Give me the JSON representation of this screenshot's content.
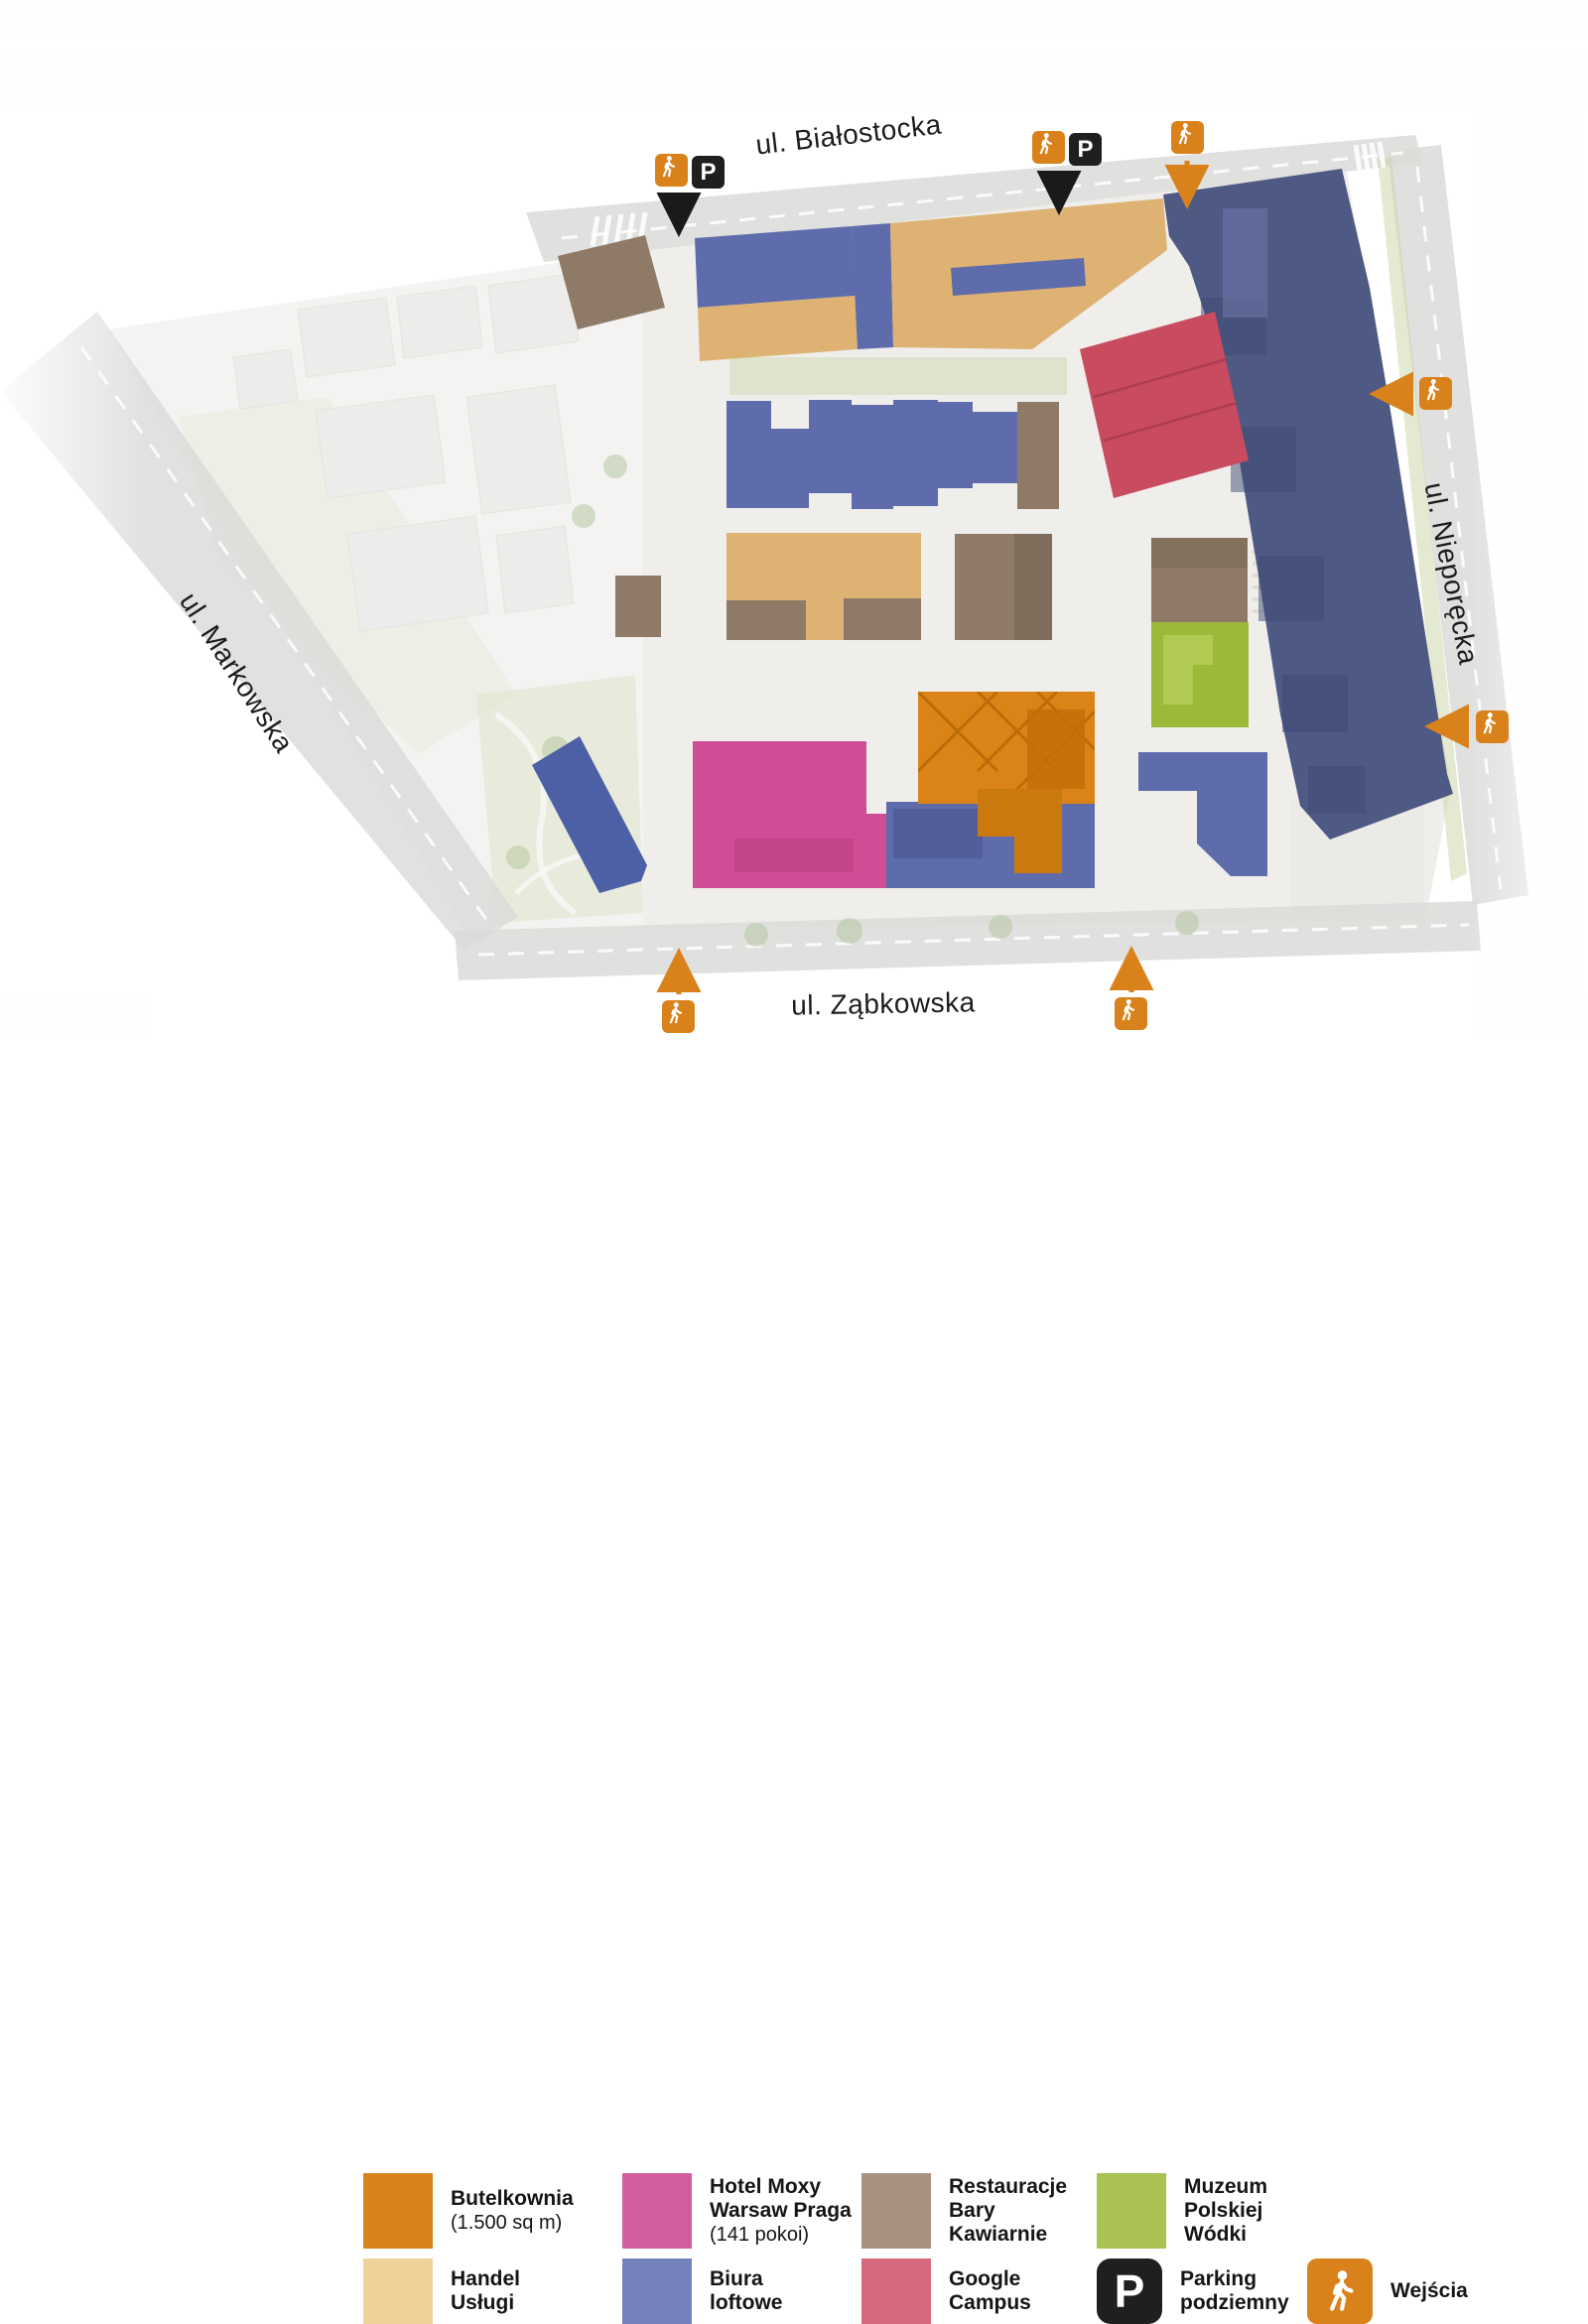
{
  "map": {
    "streets": {
      "top": "ul. Białostocka",
      "left": "ul. Markowska",
      "right": "ul. Nieporęcka",
      "bottom": "ul. Ząbkowska"
    }
  },
  "icons": {
    "parking_glyph": "P"
  },
  "palette": {
    "orange": "#d9821c",
    "pink": "#d45d9e",
    "taupe": "#a89181",
    "green": "#a9c253",
    "tan": "#eed29a",
    "blue": "#7581bd",
    "red": "#d8687c",
    "black": "#1f1f1f",
    "orange_building": "#da8316",
    "orange_building_dark": "#c9790e",
    "pink_building": "#cf4d95",
    "brown_building": "#8f7a68",
    "green_building": "#9cb93a",
    "tan_building": "#deb272",
    "blue_building": "#5f6cab",
    "blue_deep": "#4d5fa5",
    "navy_building": "#4e5984",
    "red_building": "#c84b60",
    "arrow_black": "#1a1a1a"
  },
  "legend": {
    "items": [
      {
        "l1": "Butelkownia",
        "sub": "(1.500 sq m)"
      },
      {
        "l1": "Hotel Moxy",
        "l2": "Warsaw Praga",
        "sub": "(141 pokoi)"
      },
      {
        "l1": "Restauracje",
        "l2": "Bary",
        "l3": "Kawiarnie"
      },
      {
        "l1": "Muzeum",
        "l2": "Polskiej",
        "l3": "Wódki"
      },
      {
        "l1": "Handel",
        "l2": "Usługi"
      },
      {
        "l1": "Biura",
        "l2": "loftowe"
      },
      {
        "l1": "Google",
        "l2": "Campus"
      },
      {
        "l1": "Parking",
        "l2": "podziemny"
      },
      {
        "l1": "Wejścia"
      }
    ]
  }
}
